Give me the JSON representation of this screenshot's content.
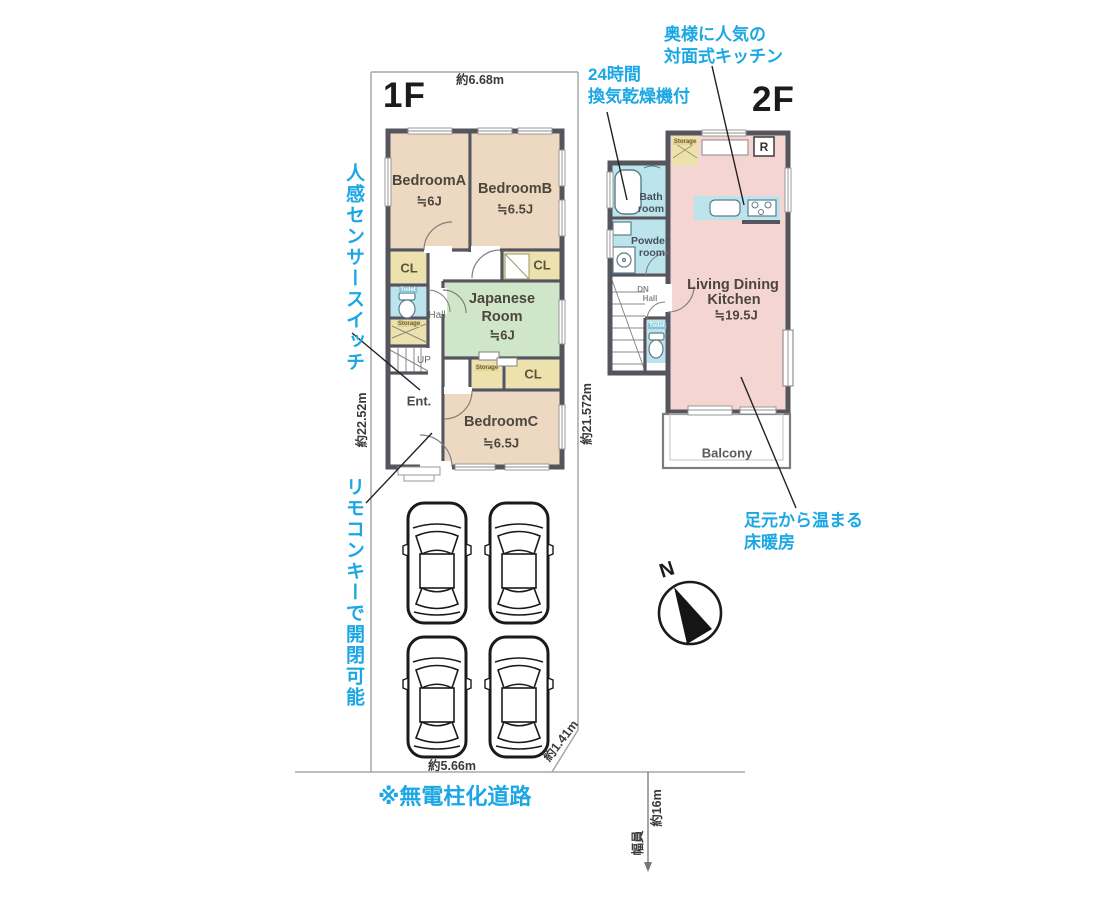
{
  "floor1": {
    "label": "1F",
    "rooms": {
      "bedroomA": {
        "name": "BedroomA",
        "size": "≒6J"
      },
      "bedroomB": {
        "name": "BedroomB",
        "size": "≒6.5J"
      },
      "japanese": {
        "line1": "Japanese",
        "line2": "Room",
        "size": "≒6J"
      },
      "bedroomC": {
        "name": "BedroomC",
        "size": "≒6.5J"
      }
    },
    "labels": {
      "cl_a": "CL",
      "cl_b": "CL",
      "cl_c": "CL",
      "toilet": "Toilet",
      "storage_hall": "Storage",
      "storage_jp": "Storage",
      "hall": "Hall",
      "up": "UP",
      "ent": "Ent."
    }
  },
  "floor2": {
    "label": "2F",
    "rooms": {
      "bath": {
        "line1": "Bath",
        "line2": "room"
      },
      "powder": {
        "line1": "Powder",
        "line2": "room"
      },
      "ldk": {
        "line1": "Living Dining",
        "line2": "Kitchen",
        "size": "≒19.5J"
      },
      "balcony": "Balcony"
    },
    "labels": {
      "storage": "Storage",
      "fridge": "R",
      "dn": "DN",
      "hall": "Hall",
      "toilet": "Toilet"
    }
  },
  "annotations": {
    "motion_sensor": "人感センサースイッチ",
    "remote_key": "リモコンキーで開閉可能",
    "ventilation_line1": "24時間",
    "ventilation_line2": "換気乾燥機付",
    "kitchen_line1": "奥様に人気の",
    "kitchen_line2": "対面式キッチン",
    "heating_line1": "足元から温まる",
    "heating_line2": "床暖房",
    "road_note": "※無電柱化道路"
  },
  "dimensions": {
    "top_width": "約6.68m",
    "left_depth": "約22.52m",
    "right_depth": "約21.572m",
    "bottom_width": "約5.66m",
    "corner_cut": "約1.41m",
    "road_width_label": "幅員",
    "road_width_value": "約16m"
  },
  "compass": {
    "north": "N"
  },
  "colors": {
    "accent": "#1ba7e4",
    "wall": "#55555e",
    "bedroom": "#edd9c1",
    "japanese_room": "#cfe6c8",
    "water": "#bce4ec",
    "ldk": "#f4d5d1",
    "closet": "#ede2ae"
  }
}
